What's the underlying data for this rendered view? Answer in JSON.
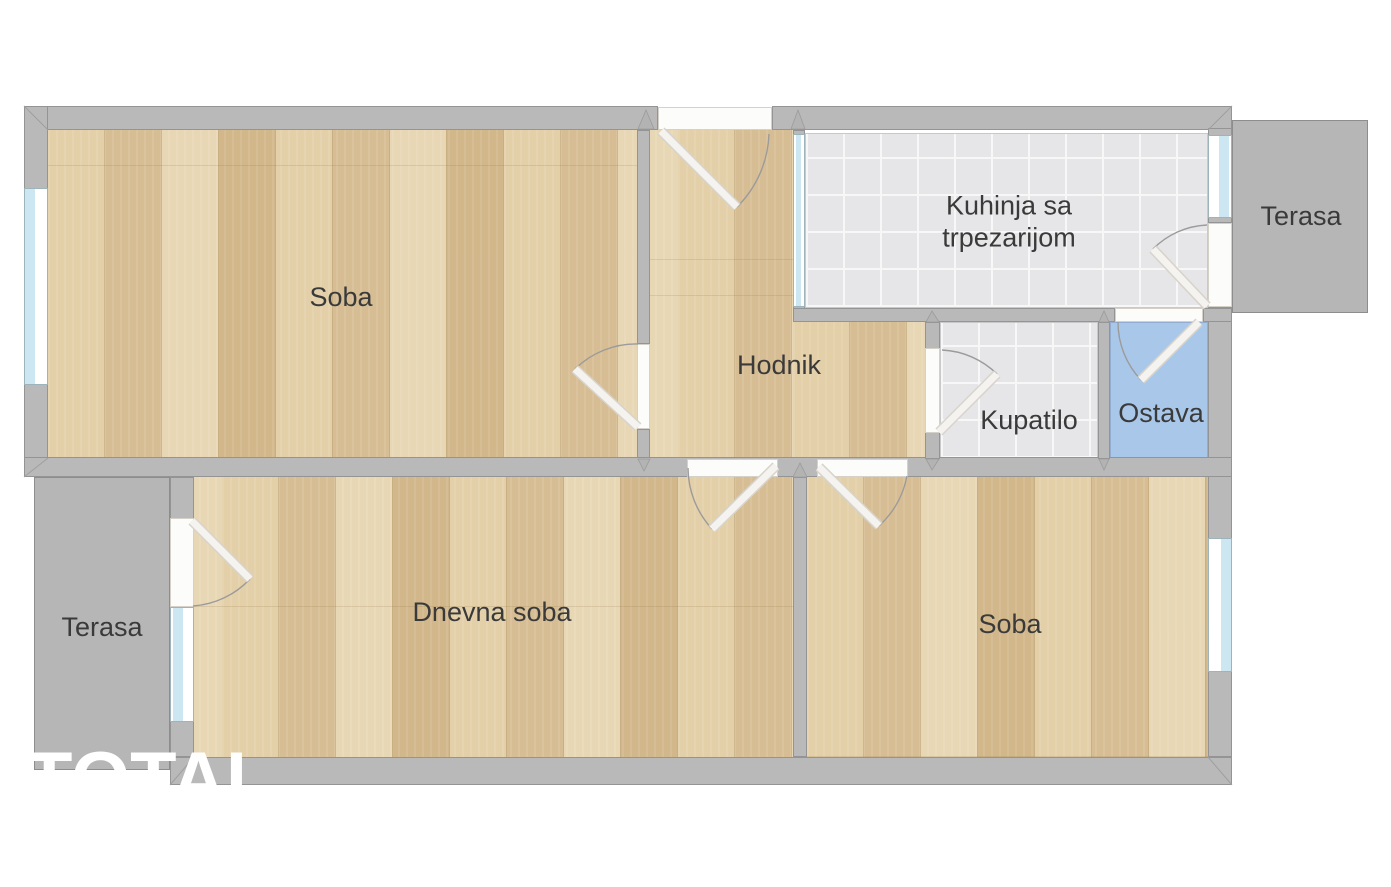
{
  "type": "apartment-floor-plan",
  "rooms": {
    "soba_top": {
      "label": "Soba",
      "floor": "wood"
    },
    "kitchen": {
      "label": "Kuhinja sa trpezarijom",
      "floor": "tile"
    },
    "terrace_top": {
      "label": "Terasa",
      "floor": "concrete"
    },
    "hallway": {
      "label": "Hodnik",
      "floor": "wood"
    },
    "bathroom": {
      "label": "Kupatilo",
      "floor": "tile"
    },
    "storage": {
      "label": "Ostava",
      "floor": "blue"
    },
    "terrace_bottom": {
      "label": "Terasa",
      "floor": "concrete"
    },
    "living_room": {
      "label": "Dnevna soba",
      "floor": "wood"
    },
    "soba_bottom": {
      "label": "Soba",
      "floor": "wood"
    }
  },
  "watermark": {
    "text": "TOTAL"
  },
  "colors": {
    "wall": "#b9b9b9",
    "terrace": "#b6b6b6",
    "wood_floor": "#dcc69f",
    "tile_floor": "#e6e6e8",
    "storage_blue": "#a9c7e8",
    "window_glass": "#cde7f2",
    "door_leaf": "#f5f3ef",
    "label_text": "#3a3a3a",
    "watermark_text": "#ffffff",
    "background": "#ffffff"
  }
}
